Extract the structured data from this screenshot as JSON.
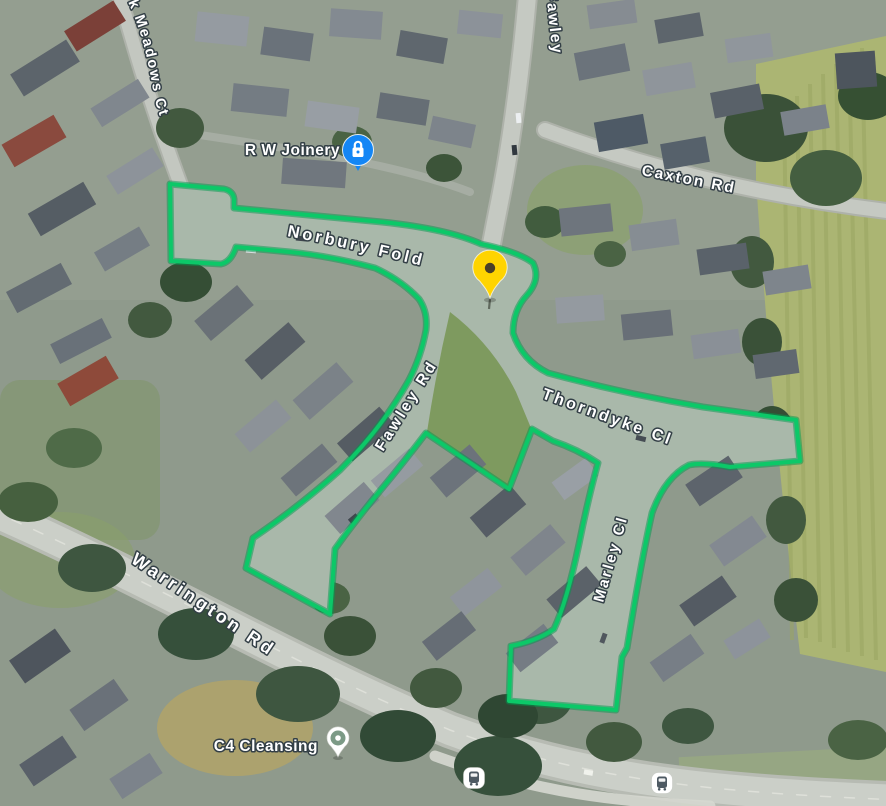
{
  "map": {
    "view_type": "satellite",
    "highlight_color": "#0cc868",
    "road_labels": [
      {
        "name": "meadows-ct",
        "text": "k Meadows Ct"
      },
      {
        "name": "fawley-north",
        "text": "Fawley"
      },
      {
        "name": "caxton-rd",
        "text": "Caxton Rd"
      },
      {
        "name": "norbury-fold",
        "text": "Norbury Fold"
      },
      {
        "name": "fawley-rd",
        "text": "Fawley Rd"
      },
      {
        "name": "thorndyke-cl",
        "text": "Thorndyke Cl"
      },
      {
        "name": "marley-cl",
        "text": "Marley Cl"
      },
      {
        "name": "warrington-rd",
        "text": "Warrington Rd"
      }
    ],
    "pois": [
      {
        "name": "rw-joinery",
        "text": "R W Joinery",
        "pin_color": "#1486f5"
      },
      {
        "name": "c4-cleansing",
        "text": "C4 Cleansing",
        "pin_color": "#ffffff"
      }
    ],
    "marker": {
      "name": "selected-location",
      "color": "#ffd400"
    },
    "transit": [
      {
        "name": "bus-stop-west"
      },
      {
        "name": "bus-stop-east"
      }
    ]
  }
}
